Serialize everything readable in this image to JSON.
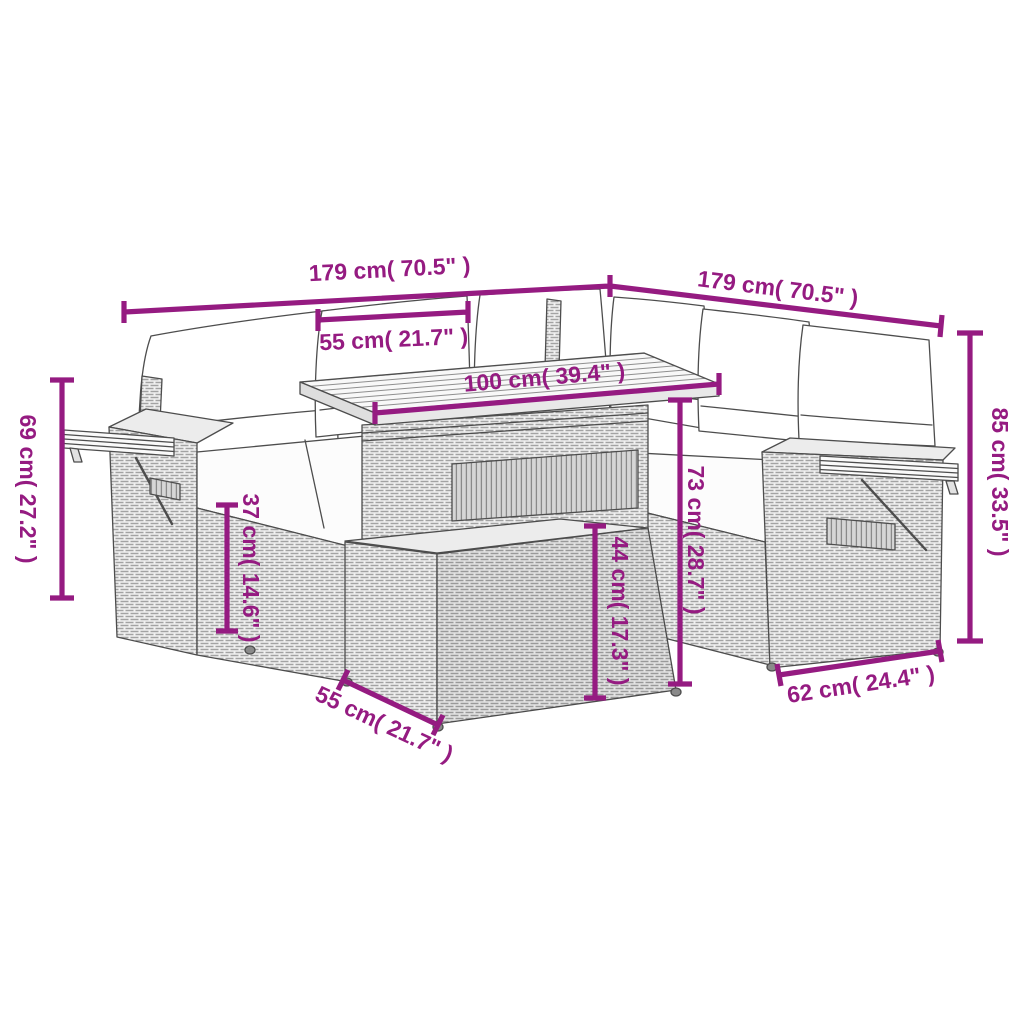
{
  "image": {
    "type": "product-dimension-diagram",
    "subject": "Rattan garden lounge corner sofa set with cushions, slatted table, fold-out armrest trays and footstool",
    "background_color": "#ffffff",
    "line_art_color": "#4d4d4d",
    "dimension_color": "#951b81"
  },
  "dims": {
    "sofa_left_width": "179 cm( 70.5\" )",
    "sofa_right_width": "179 cm( 70.5\" )",
    "back_cushion_width": "55 cm( 21.7\" )",
    "table_length": "100 cm( 39.4\" )",
    "armrest_height": "69 cm( 27.2\" )",
    "seat_height": "37 cm( 14.6\" )",
    "table_height": "73 cm( 28.7\" )",
    "footstool_height": "44 cm( 17.3\" )",
    "total_height": "85 cm( 33.5\" )",
    "seat_depth": "62 cm( 24.4\" )",
    "footstool_width": "55 cm( 21.7\" )"
  }
}
